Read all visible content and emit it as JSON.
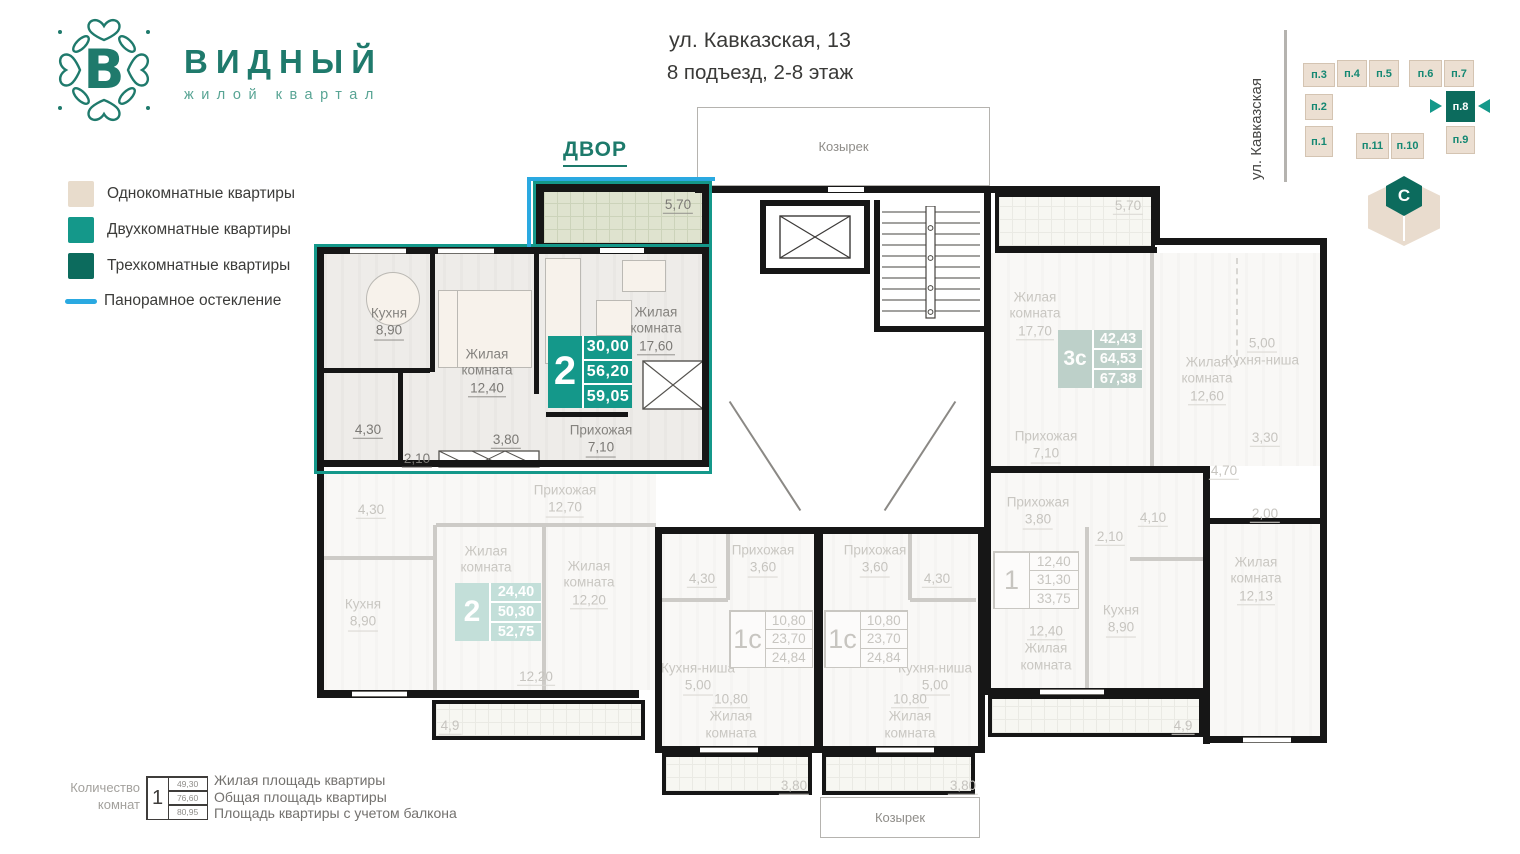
{
  "logo": {
    "title": "ВИДНЫЙ",
    "subtitle": "жилой квартал"
  },
  "header": {
    "address": "ул. Кавказская, 13",
    "entrance": "8 подъезд, 2-8 этаж"
  },
  "legend": {
    "one": "Однокомнатные квартиры",
    "two": "Двухкомнатные квартиры",
    "three": "Трехкомнатные квартиры",
    "pano": "Панорамное остекление"
  },
  "colors": {
    "one": "#e8dccc",
    "two": "#14988a",
    "three": "#0c6b5d",
    "pano": "#2aa9e1"
  },
  "minimap": {
    "street": "ул. Кавказская",
    "selected": "п.8",
    "blocks": {
      "b1": "п.1",
      "b2": "п.2",
      "b3": "п.3",
      "b4": "п.4",
      "b5": "п.5",
      "b6": "п.6",
      "b7": "п.7",
      "b8": "п.8",
      "b9": "п.9",
      "b10": "п.10",
      "b11": "п.11"
    }
  },
  "compass": {
    "north": "С"
  },
  "plan": {
    "dvor": "ДВОР",
    "canopy_top": "Козырек",
    "canopy_bottom": "Козырек",
    "apartments": {
      "a": {
        "stat": {
          "rooms": "2",
          "values": [
            "30,00",
            "56,20",
            "59,05"
          ]
        },
        "kitchen": {
          "name": "Кухня",
          "area": "8,90"
        },
        "bedroom": {
          "name": "Жилая комната",
          "area": "12,40"
        },
        "living": {
          "name": "Жилая комната",
          "area": "17,60"
        },
        "hall": {
          "name": "Прихожая",
          "area": "7,10"
        },
        "bath": "4,30",
        "wc": "2,10",
        "corridor": "3,80",
        "balcony": "5,70"
      },
      "b": {
        "stat": {
          "rooms": "2",
          "values": [
            "24,40",
            "50,30",
            "52,75"
          ]
        },
        "hall": {
          "name": "Прихожая",
          "area": "12,70"
        },
        "kitchen": {
          "name": "Кухня",
          "area": "8,90"
        },
        "bedroom1": {
          "name": "Жилая комната",
          "area": "12,20"
        },
        "bedroom2": {
          "name": "Жилая комната",
          "area": "12,20"
        },
        "bath": "4,30",
        "balcony": "4,9"
      },
      "c": {
        "stat": {
          "rooms": "1с",
          "values": [
            "10,80",
            "23,70",
            "24,84"
          ]
        },
        "hall": {
          "name": "Прихожая",
          "area": "3,60"
        },
        "kitchen": {
          "name": "Кухня-ниша",
          "area": "5,00"
        },
        "living": {
          "name": "Жилая комната",
          "area": "10,80"
        },
        "bath": "4,30",
        "balcony": "3,80"
      },
      "d": {
        "stat": {
          "rooms": "1с",
          "values": [
            "10,80",
            "23,70",
            "24,84"
          ]
        },
        "hall": {
          "name": "Прихожая",
          "area": "3,60"
        },
        "kitchen": {
          "name": "Кухня-ниша",
          "area": "5,00"
        },
        "living": {
          "name": "Жилая комната",
          "area": "10,80"
        },
        "bath": "4,30",
        "balcony": "3,80"
      },
      "e": {
        "stat": {
          "rooms": "3с",
          "values": [
            "42,43",
            "64,53",
            "67,38"
          ]
        },
        "living1": {
          "name": "Жилая комната",
          "area": "17,70"
        },
        "living2": {
          "name": "Жилая комната",
          "area": "12,60"
        },
        "living3": {
          "name": "Жилая комната",
          "area": "12,13"
        },
        "kitchen": {
          "name": "Кухня-ниша",
          "area": "5,00"
        },
        "hall": {
          "name": "Прихожая",
          "area": "7,10"
        },
        "bath": "3,30",
        "hall2": "4,70",
        "wc": "2,00",
        "balcony": "5,70"
      },
      "f": {
        "stat": {
          "rooms": "1",
          "values": [
            "12,40",
            "31,30",
            "33,75"
          ]
        },
        "hall": {
          "name": "Прихожая",
          "area": "3,80"
        },
        "kitchen": {
          "name": "Кухня",
          "area": "8,90"
        },
        "living": {
          "name": "Жилая комната",
          "area": "12,40"
        },
        "wc": "2,10",
        "bath": "4,10",
        "balcony": "4,9"
      }
    }
  },
  "footer": {
    "count_label_1": "Количество",
    "count_label_2": "комнат",
    "sample": {
      "rooms": "1",
      "values": [
        "49,30",
        "76,60",
        "80,95"
      ]
    },
    "lines": [
      "Жилая площадь квартиры",
      "Общая площадь квартиры",
      "Площадь квартиры с учетом балкона"
    ]
  }
}
